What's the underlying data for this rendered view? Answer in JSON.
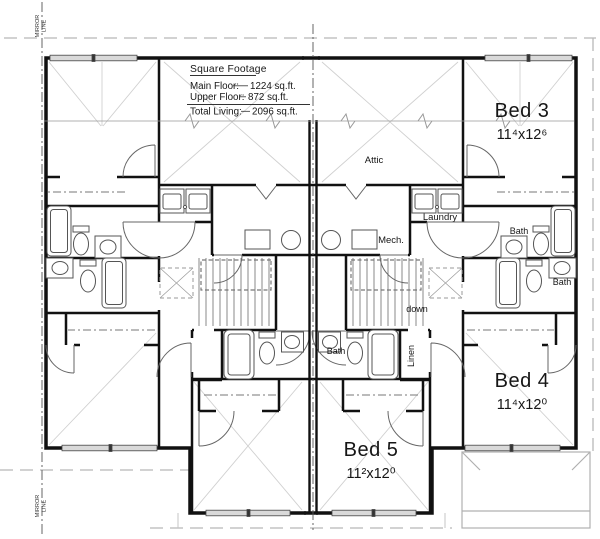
{
  "plan": {
    "square_footage": {
      "heading": "Square Footage",
      "rows": [
        {
          "label": "Main Floor:",
          "value": "1224 sq.ft."
        },
        {
          "label": "Upper Floor:",
          "value": "872 sq.ft."
        },
        {
          "label": "Total Living:",
          "value": "2096 sq.ft."
        }
      ]
    },
    "rooms": {
      "bed3": {
        "name": "Bed 3",
        "dims": "11⁴x12⁶"
      },
      "bed4": {
        "name": "Bed 4",
        "dims": "11⁴x12⁰"
      },
      "bed5": {
        "name": "Bed 5",
        "dims": "11²x12⁰"
      }
    },
    "labels": {
      "attic": "Attic",
      "laundry": "Laundry",
      "mech": "Mech.",
      "bath": "Bath",
      "linen": "Linen",
      "down": "down"
    },
    "mirror_line": {
      "word1": "MIRROR",
      "word2": "LINE"
    },
    "colors": {
      "wall_ink": "#111111",
      "fixture_ink": "#555555",
      "roof_dash": "#b8b8b8",
      "window_fill": "#d9d9d9"
    }
  }
}
